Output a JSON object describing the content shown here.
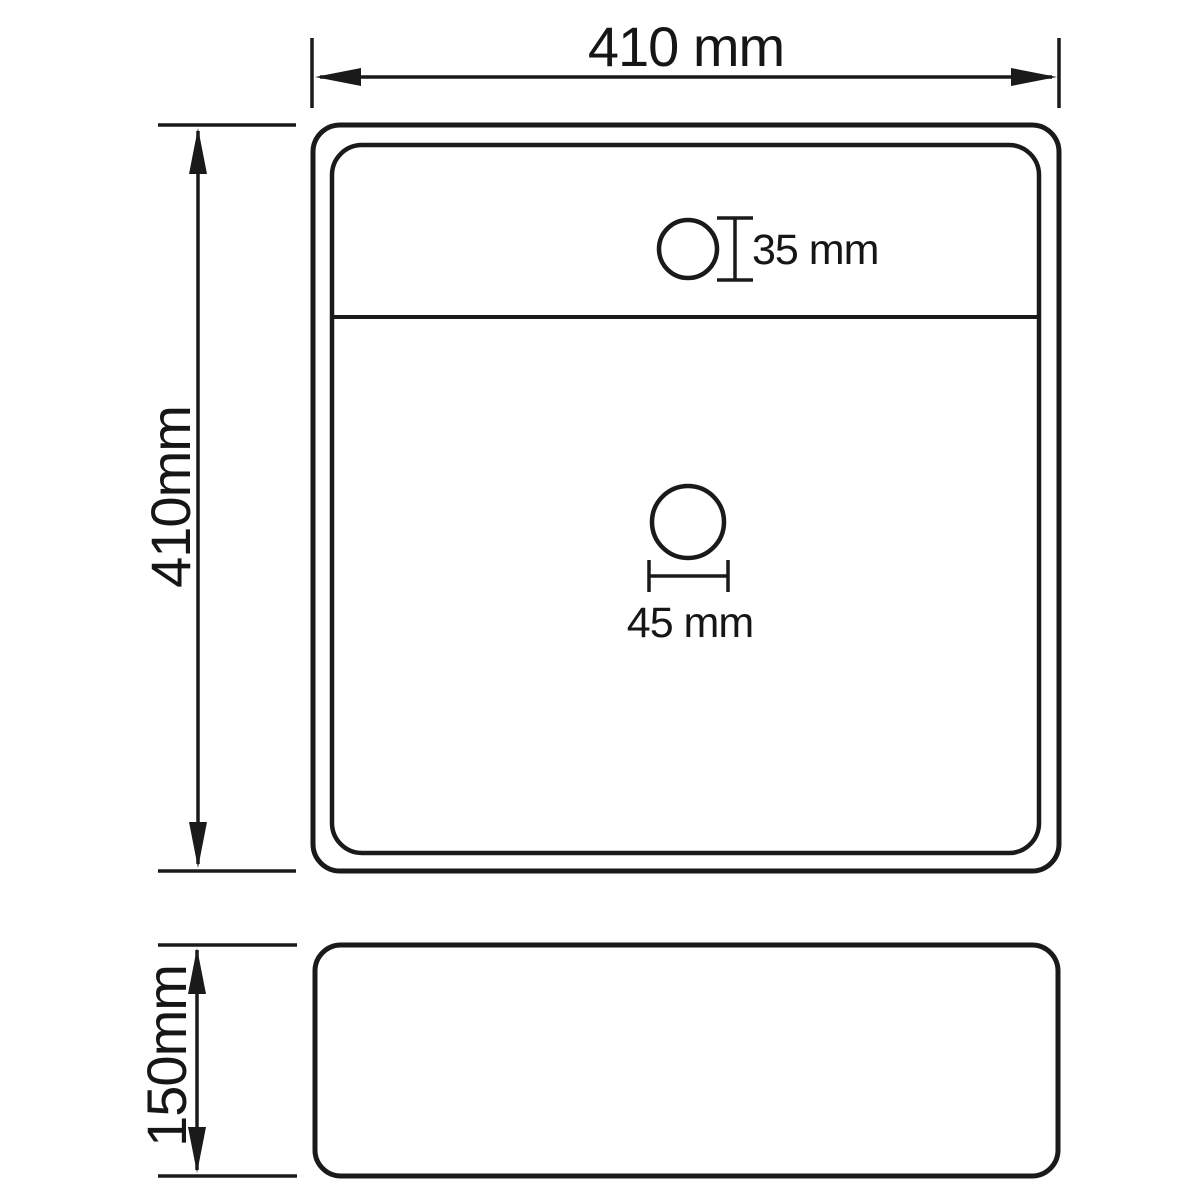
{
  "diagram": {
    "type": "technical-drawing",
    "subject": "square-washbasin-dimension-drawing",
    "background_color": "#ffffff",
    "line_color": "#1a1a1a",
    "top_view": {
      "width_label": "410 mm",
      "height_label": "410mm",
      "faucet_hole_label": "35 mm",
      "drain_hole_label": "45 mm"
    },
    "side_view": {
      "height_label": "150mm"
    }
  }
}
